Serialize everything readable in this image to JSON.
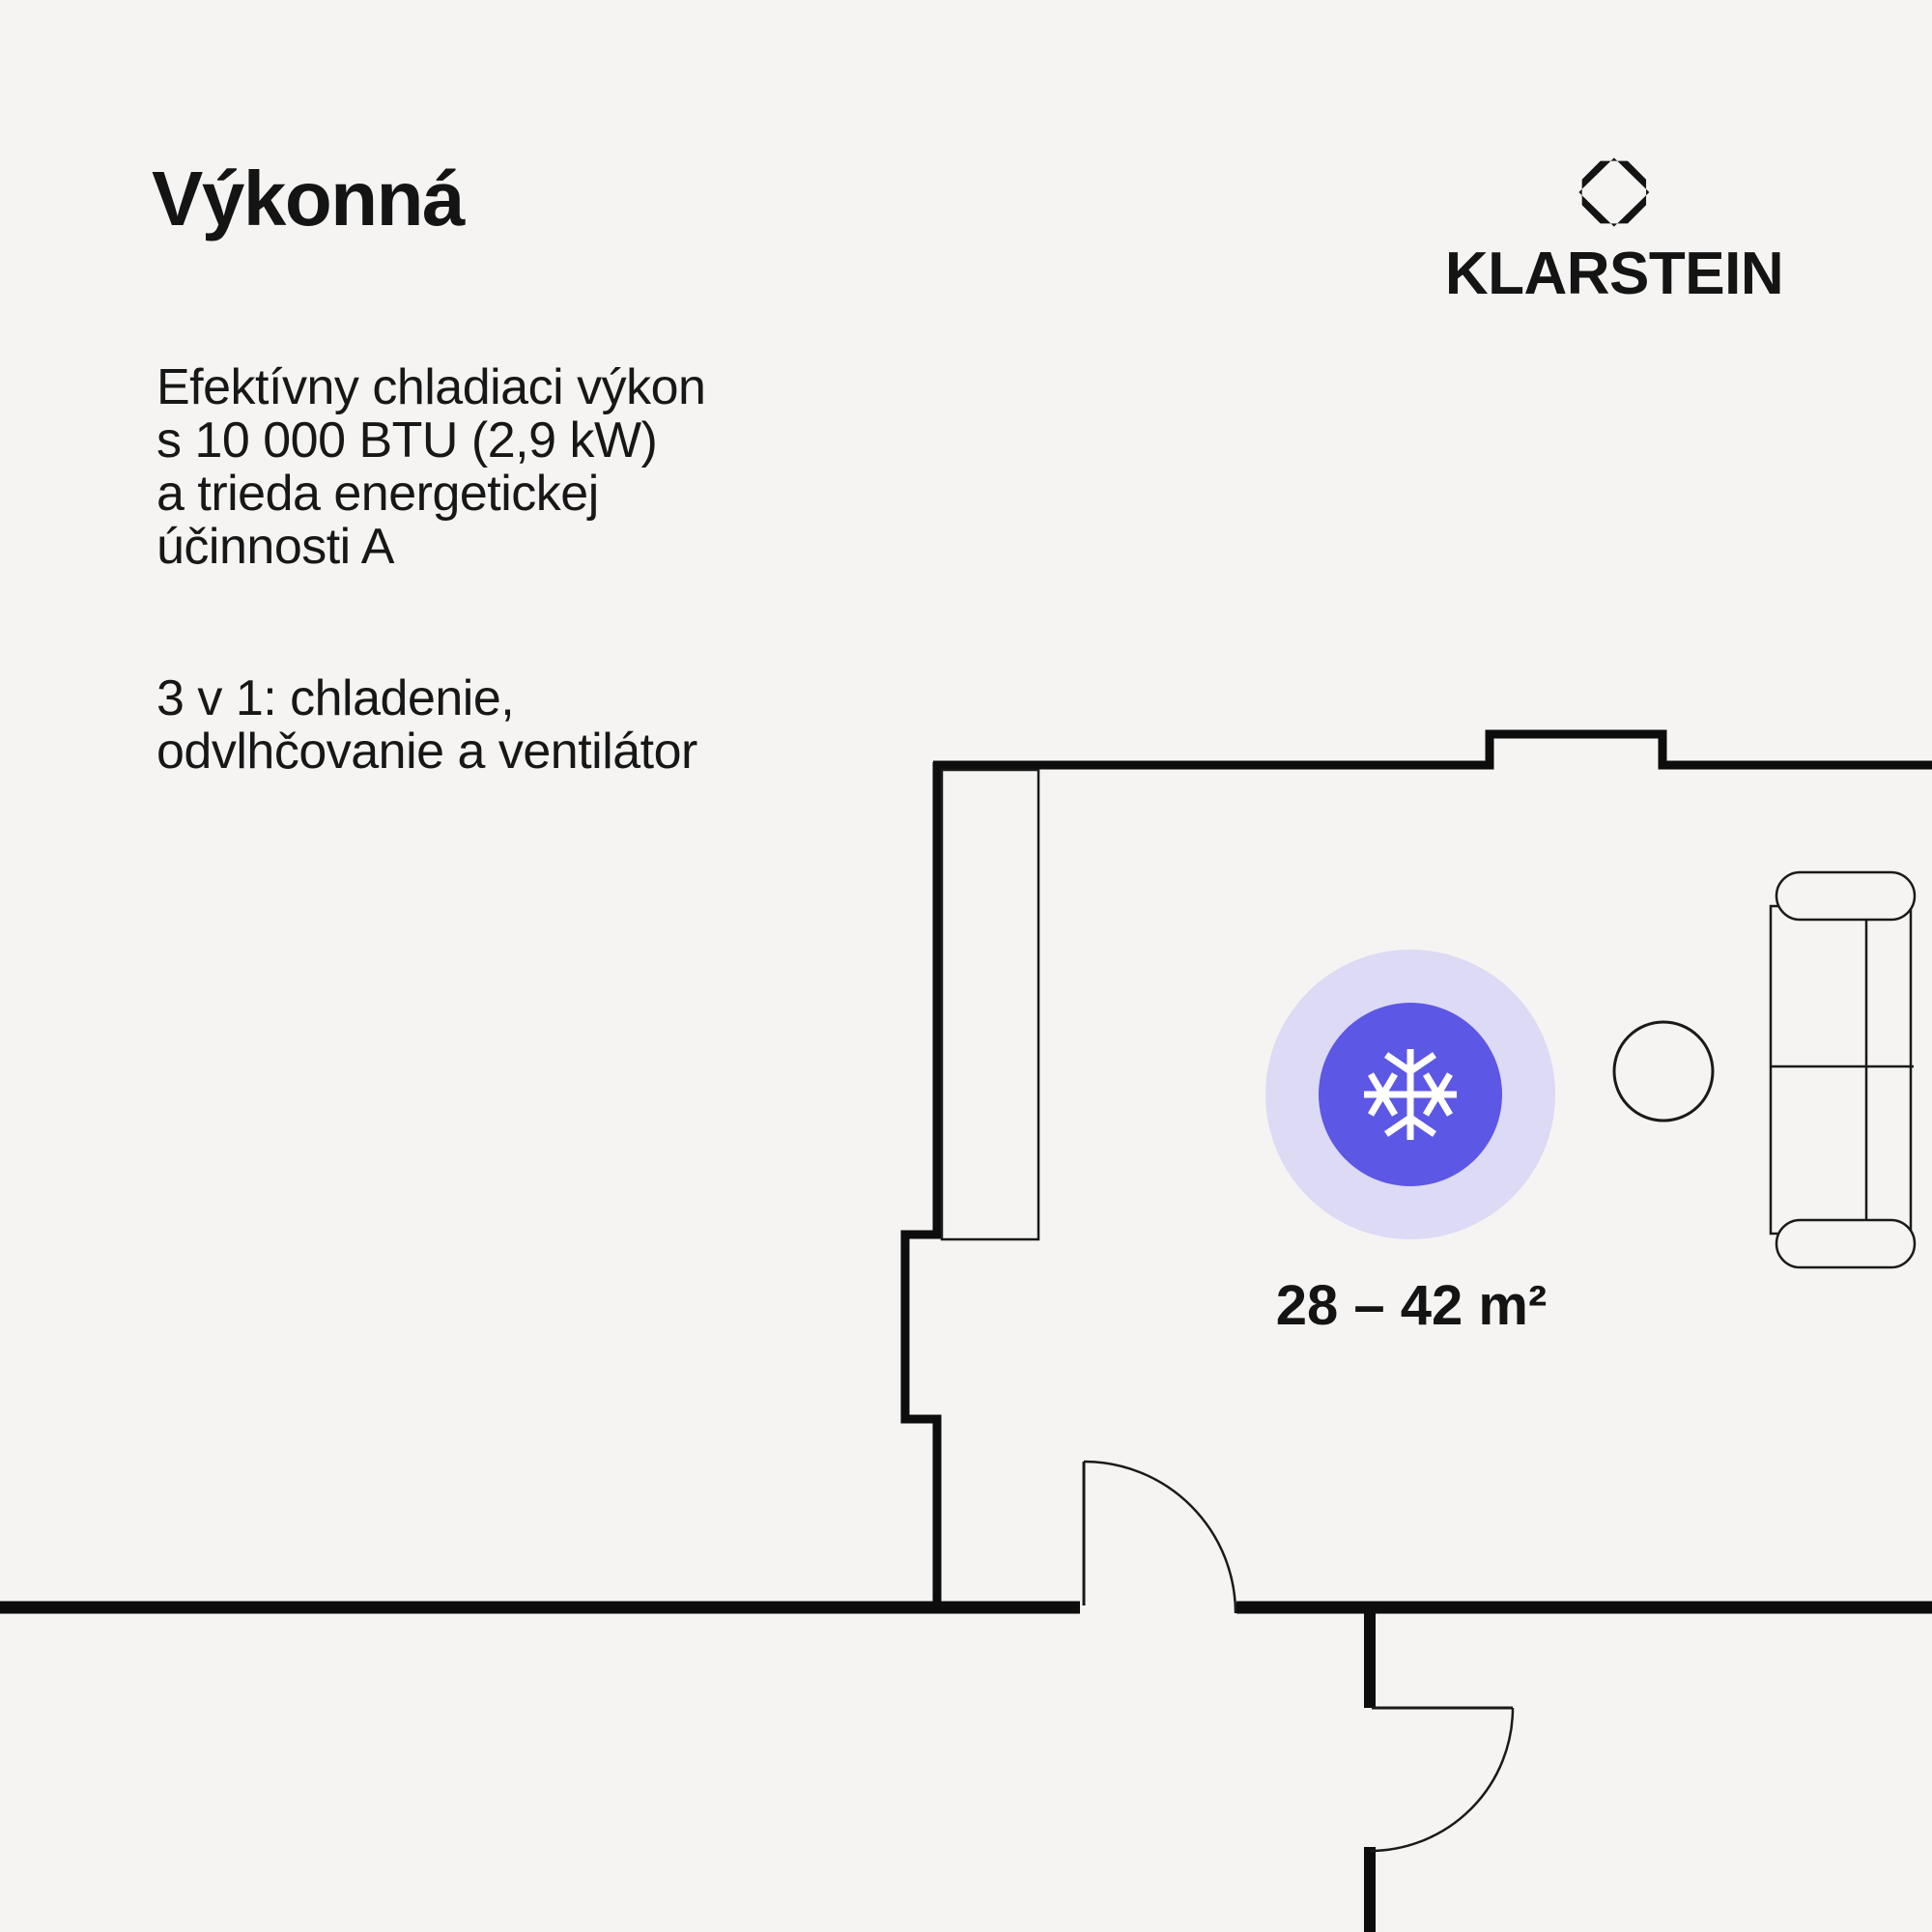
{
  "colors": {
    "background": "#f5f4f2",
    "ink": "#0d0d0d",
    "accent_blue": "#5c57e4",
    "accent_halo": "#dcdaf4",
    "snowflake": "#ffffff"
  },
  "headline": {
    "title": "Výkonná"
  },
  "copy": {
    "paragraph1": {
      "lines": [
        "Efektívny chladiaci výkon",
        "s 10 000 BTU (2,9 kW)",
        "a trieda energetickej",
        "účinnosti A"
      ]
    },
    "paragraph2": {
      "lines": [
        "3 v 1: chladenie,",
        "odvlhčovanie a ventilátor"
      ]
    }
  },
  "brand": {
    "wordmark": "KLARSTEIN"
  },
  "floorplan": {
    "area_label": "28 – 42 m²"
  }
}
